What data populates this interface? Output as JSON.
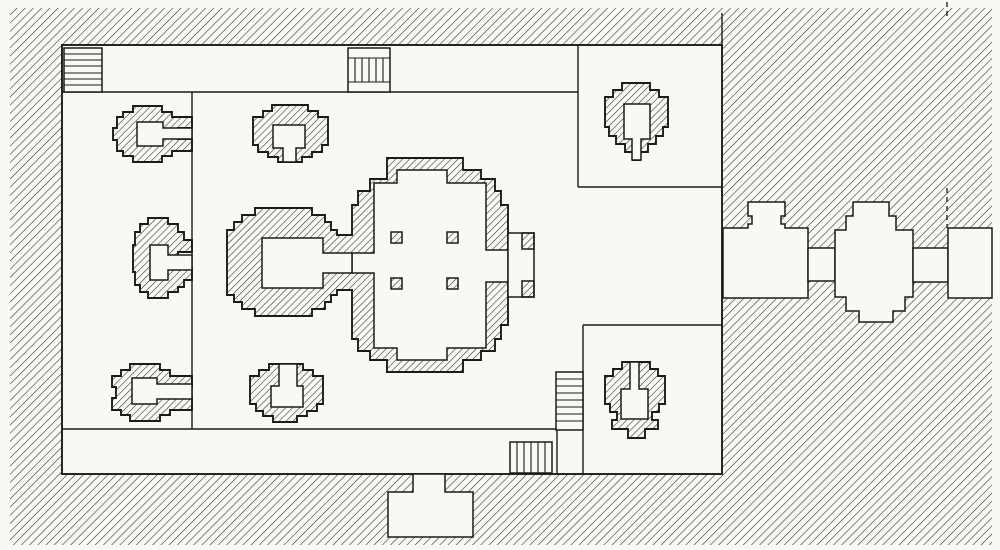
{
  "figure": {
    "alt": "Engraved floor plan of a walled temple compound: central cruciform sanctuary with western antechamber and eastern porch, four interior pillars, six subsidiary shrines, corner enclosures, four stairways, an eastern causeway with two gate pavilions, and a south gate chamber set in a hatched ground mass."
  },
  "palette": {
    "paper": "#f9f8f4",
    "ink": "#1b1b1b",
    "hatch": "#2e2e2e"
  },
  "elements": [
    "ground-hatch",
    "courtyard",
    "north-gallery-line",
    "west-precinct-line",
    "south-gallery-line",
    "ne-enclosure-lines",
    "se-enclosure-lines",
    "nw-stairs",
    "north-stairs",
    "se-stairs",
    "south-stairs",
    "south-passage-line",
    "north-wall-stub-line",
    "survey-dash-line",
    "central-sanctuary",
    "sanctuary-interior",
    "antechamber-interior",
    "east-porch",
    "sanctuary-pillars",
    "shrine-nw",
    "shrine-w",
    "shrine-sw",
    "shrine-n",
    "shrine-s",
    "shrine-ne",
    "shrine-se",
    "east-gate-inner",
    "east-gate-outer",
    "causeway-corridor-inner",
    "causeway-corridor-outer",
    "east-passage",
    "south-gate"
  ]
}
